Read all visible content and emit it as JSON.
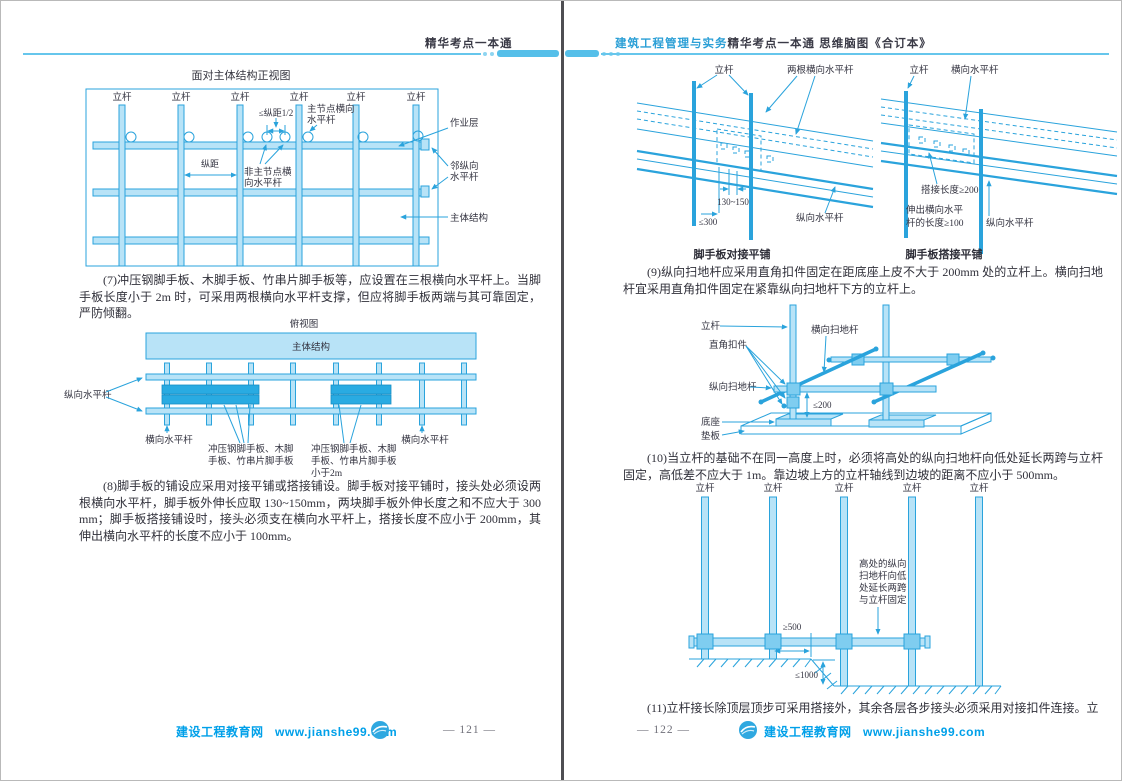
{
  "colors": {
    "diagram_stroke": "#2aa3dc",
    "diagram_fill_light": "#b8e3f7",
    "board_fill": "#29abe2",
    "coupler_fill": "#7fcdf0",
    "header_bar": "#55bfe9",
    "header_blue_text": "#2b9fd6",
    "footer_link_blue": "#00a0e9",
    "body_text": "#30303a"
  },
  "left": {
    "header": {
      "title": "精华考点一本通"
    },
    "fig_front": {
      "title": "面对主体结构正视图",
      "pole": "立杆",
      "span_half": "≤纵距1/2",
      "main_node_l1": "主节点横向",
      "main_node_l2": "水平杆",
      "work_layer": "作业层",
      "span": "纵距",
      "non_main_l1": "非主节点横",
      "non_main_l2": "向水平杆",
      "adjacent_l1": "邻纵向",
      "adjacent_l2": "水平杆",
      "main_structure": "主体结构"
    },
    "para7": "(7)冲压钢脚手板、木脚手板、竹串片脚手板等，应设置在三根横向水平杆上。当脚手板长度小于 2m 时，可采用两根横向水平杆支撑，但应将脚手板两端与其可靠固定，严防倾翻。",
    "fig_top": {
      "title": "俯视图",
      "main_structure": "主体结构",
      "longitudinal": "纵向水平杆",
      "transverse_left": "横向水平杆",
      "transverse_right": "横向水平杆",
      "board_l1": "冲压钢脚手板、木脚",
      "board_l2": "手板、竹串片脚手板",
      "board_short_l3": "小于2m"
    },
    "para8": "(8)脚手板的铺设应采用对接平铺或搭接铺设。脚手板对接平铺时，接头处必须设两根横向水平杆，脚手板外伸长应取 130~150mm，两块脚手板外伸长度之和不应大于 300mm；脚手板搭接铺设时，接头必须支在横向水平杆上，搭接长度不应小于 200mm，其伸出横向水平杆的长度不应小于 100mm。",
    "footer": {
      "site": "建设工程教育网",
      "url": "www.jianshe99.com",
      "page": "— 121 —"
    }
  },
  "right": {
    "header": {
      "title_practice": "建筑工程管理与实务",
      "title_core": "精华考点一本通",
      "title_map": "思维脑图《合订本》"
    },
    "fig_butt": {
      "pole": "立杆",
      "two_bars": "两根横向水平杆",
      "dim_ext": "130~150",
      "dim_sum": "≤300",
      "longitudinal": "纵向水平杆",
      "caption": "脚手板对接平铺"
    },
    "fig_lap": {
      "pole": "立杆",
      "transverse": "横向水平杆",
      "lap_len": "搭接长度≥200",
      "ext_l1": "伸出横向水平",
      "ext_l2": "杆的长度≥100",
      "longitudinal": "纵向水平杆",
      "caption": "脚手板搭接平铺"
    },
    "para9": "(9)纵向扫地杆应采用直角扣件固定在距底座上皮不大于 200mm 处的立杆上。横向扫地杆宜采用直角扣件固定在紧靠纵向扫地杆下方的立杆上。",
    "fig_sweep": {
      "pole": "立杆",
      "transverse_sweep": "横向扫地杆",
      "coupler": "直角扣件",
      "longitudinal_sweep": "纵向扫地杆",
      "dim": "≤200",
      "base": "底座",
      "pad": "垫板"
    },
    "para10": "(10)当立杆的基础不在同一高度上时，必须将高处的纵向扫地杆向低处延长两跨与立杆固定，高低差不应大于 1m。靠边坡上方的立杆轴线到边坡的距离不应小于 500mm。",
    "fig_slope": {
      "pole": "立杆",
      "note_l1": "高处的纵向",
      "note_l2": "扫地杆向低",
      "note_l3": "处延长两跨",
      "note_l4": "与立杆固定",
      "dim_500": "≥500",
      "dim_1000": "≤1000"
    },
    "para11": "(11)立杆接长除顶层顶步可采用搭接外，其余各层各步接头必须采用对接扣件连接。立",
    "footer": {
      "page": "— 122 —",
      "site": "建设工程教育网",
      "url": "www.jianshe99.com"
    }
  }
}
